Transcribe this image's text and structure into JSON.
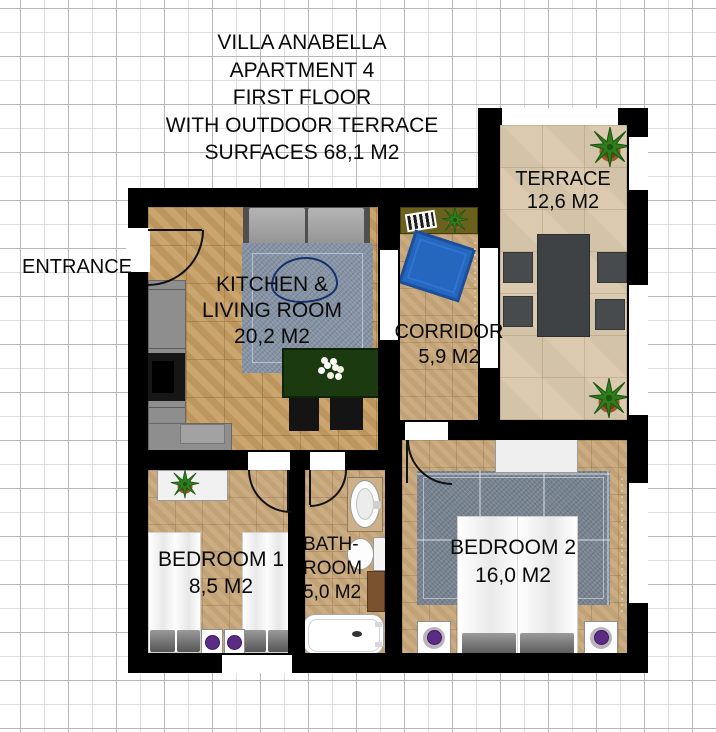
{
  "title": {
    "lines": [
      "VILLA ANABELLA",
      "APARTMENT 4",
      "FIRST FLOOR",
      "WITH OUTDOOR TERRACE",
      "SURFACES 68,1 M2"
    ]
  },
  "labels": {
    "entrance": "ENTRANCE"
  },
  "rooms": {
    "kitchen_living": {
      "name": "KITCHEN & LIVING ROOM",
      "area": "20,2 M2",
      "lines": [
        "KITCHEN &",
        "LIVING ROOM",
        "20,2 M2"
      ]
    },
    "corridor": {
      "name": "CORRIDOR",
      "area": "5,9 M2",
      "lines": [
        "CORRIDOR",
        "5,9 M2"
      ]
    },
    "terrace": {
      "name": "TERRACE",
      "area": "12,6 M2",
      "lines": [
        "TERRACE",
        "12,6 M2"
      ]
    },
    "bedroom1": {
      "name": "BEDROOM 1",
      "area": "8,5 M2",
      "lines": [
        "BEDROOM 1",
        "8,5 M2"
      ]
    },
    "bathroom": {
      "name": "BATHROOM",
      "area": "5,0 M2",
      "lines": [
        "BATH-",
        "ROOM",
        "5,0 M2"
      ]
    },
    "bedroom2": {
      "name": "BEDROOM 2",
      "area": "16,0 M2",
      "lines": [
        "BEDROOM 2",
        "16,0 M2"
      ]
    }
  },
  "colors": {
    "wall": "#000000",
    "floor_wood": "#c79e63",
    "floor_tile": "#c9a97c",
    "floor_terrace": "#dbcaaf",
    "rug_living": "#8492a4",
    "rug_bedroom2": "#76828f",
    "rug_corridor_blue": "#2566be",
    "beanbag_blue": "#2f5fc0",
    "dining_table_green": "#1c3a0f",
    "kitchen_counter_gray": "#8e8e8e",
    "sofa_gray": "#9ea0a0",
    "terrace_furniture_gray": "#3e4244",
    "console_olive": "#6a611e",
    "lamp_purple": "#5b2b85",
    "plant_green": "#2f7d1d",
    "pot_brown": "#9a5a2b",
    "bath_cabinet_brown": "#7a5230",
    "grid_line": "#b6b6b6"
  }
}
